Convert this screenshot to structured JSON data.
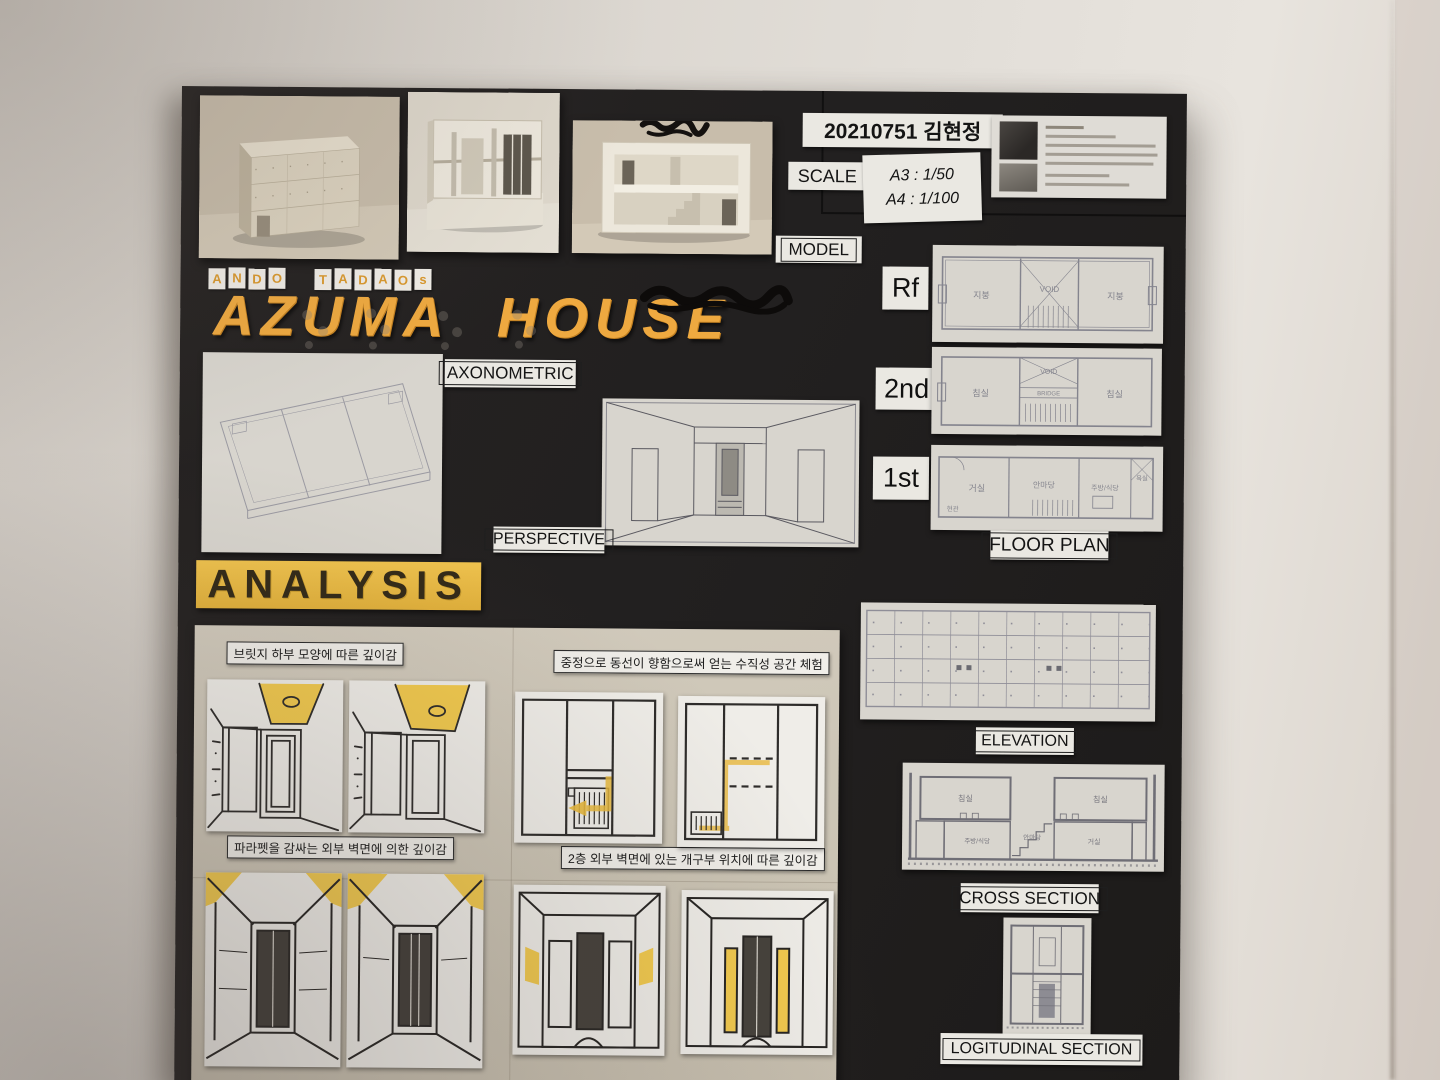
{
  "header": {
    "student_id": "20210751 김현정",
    "scale_label": "SCALE",
    "scale_lines": [
      "A3 : 1/50",
      "A4 : 1/100"
    ]
  },
  "title": {
    "architect_letters": [
      "A",
      "N",
      "D",
      "O",
      "T",
      "A",
      "D",
      "A",
      "O",
      "s"
    ],
    "house_name": "AZUMA HOUSE"
  },
  "labels": {
    "model": "MODEL",
    "axonometric": "AXONOMETRIC",
    "perspective": "PERSPECTIVE",
    "floor_plan": "FLOOR PLAN",
    "elevation": "ELEVATION",
    "cross_section": "CROSS SECTION",
    "longitudinal_section": "LOGITUDINAL SECTION",
    "analysis": "ANALYSIS"
  },
  "floors": {
    "rf": {
      "tag": "Rf",
      "room_left": "지붕",
      "room_center": "VOID",
      "room_right": "지붕"
    },
    "second": {
      "tag": "2nd",
      "room_left": "침실",
      "void": "VOID",
      "bridge": "BRIDGE",
      "room_right": "침실"
    },
    "first": {
      "tag": "1st",
      "entrance": "현관",
      "living": "거실",
      "courtyard": "안마당",
      "kitchen": "주방/식당",
      "bath": "욕실"
    }
  },
  "cross_section_rooms": {
    "top_left": "침실",
    "top_right": "침실",
    "bottom_left": "주방/식당",
    "bottom_center": "안마당",
    "bottom_right": "거실"
  },
  "analysis_captions": [
    "브릿지 하부 모양에 따른 깊이감",
    "중정으로 동선이 향함으로써 얻는 수직성 공간 체험",
    "파라펫을 감싸는 외부 벽면에 의한 깊이감",
    "2층 외부 벽면에 있는 개구부 위치에 따른 깊이감"
  ],
  "colors": {
    "board": "#242120",
    "wall": "#ddd8d1",
    "title_orange": "#eea940",
    "banner_yellow": "#edbf4a",
    "label_paper": "#eae8e2",
    "drawing_paper": "#d8d5ce",
    "tan_paper": "#cfc8b9",
    "sketch_highlight": "#f2ca4e"
  }
}
